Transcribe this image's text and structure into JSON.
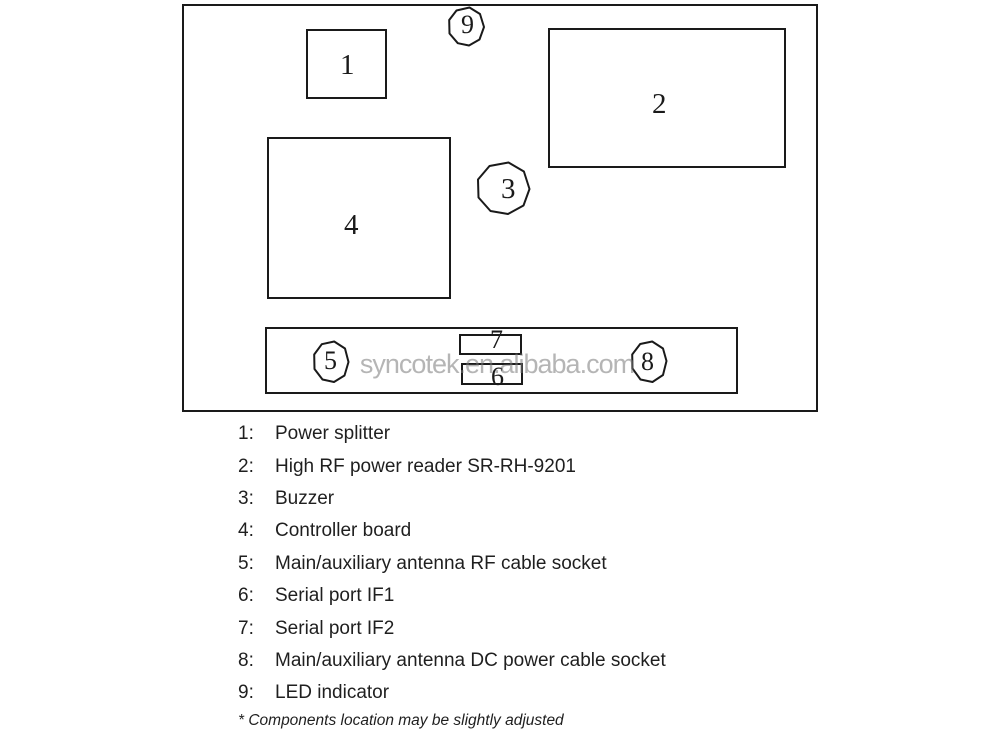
{
  "watermark": "syncotek.en.alibaba.com",
  "diagram": {
    "title": "RFID reader internal components location diagram",
    "labels": {
      "n1": "1",
      "n2": "2",
      "n3": "3",
      "n4": "4",
      "n5": "5",
      "n6": "6",
      "n7": "7",
      "n8": "8",
      "n9": "9"
    }
  },
  "legend": {
    "items": [
      {
        "num": "1:",
        "label": "Power splitter"
      },
      {
        "num": "2:",
        "label": "High RF power reader SR-RH-9201"
      },
      {
        "num": "3:",
        "label": "Buzzer"
      },
      {
        "num": "4:",
        "label": "Controller board"
      },
      {
        "num": "5:",
        "label": "Main/auxiliary antenna RF cable socket"
      },
      {
        "num": "6:",
        "label": "Serial port IF1"
      },
      {
        "num": "7:",
        "label": "Serial port IF2"
      },
      {
        "num": "8:",
        "label": "Main/auxiliary antenna DC power cable socket"
      },
      {
        "num": "9:",
        "label": "LED indicator"
      }
    ],
    "footnote": "* Components location may be slightly adjusted"
  },
  "colors": {
    "line": "#1a1a1a",
    "text": "#1f1f1f",
    "watermark_gray": "#b9b9b9",
    "background": "#ffffff"
  }
}
